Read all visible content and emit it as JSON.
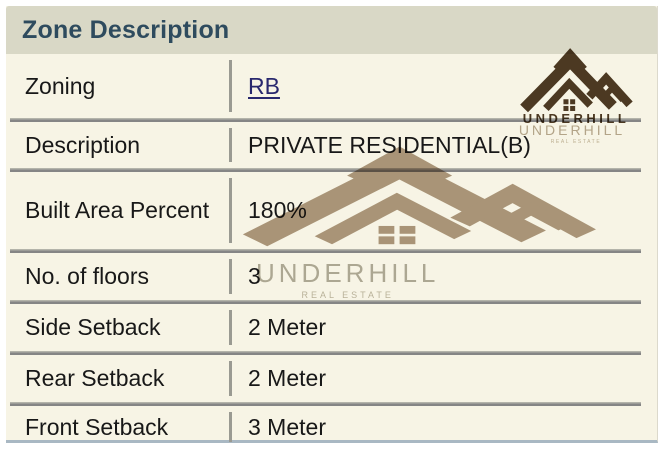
{
  "header": {
    "title": "Zone Description"
  },
  "table": {
    "rows": [
      {
        "label": "Zoning",
        "value": "RB"
      },
      {
        "label": "Description",
        "value": "PRIVATE RESIDENTIAL(B)"
      },
      {
        "label": "Built Area Percent",
        "value": "180%"
      },
      {
        "label": "No. of floors",
        "value": "3"
      },
      {
        "label": "Side Setback",
        "value": "2 Meter"
      },
      {
        "label": "Rear Setback",
        "value": "2 Meter"
      },
      {
        "label": "Front Setback",
        "value": "3 Meter"
      }
    ]
  },
  "branding": {
    "logo_icon": "underhill-roofs-icon",
    "brand": "UNDERHILL",
    "tagline": "REAL ESTATE"
  },
  "colors": {
    "header-bg": "#d9d8c6",
    "title": "#2e4b5e",
    "body-bg": "#f7f4e5",
    "text": "#181818",
    "link": "#29286e",
    "separator": "#858585",
    "separator-light": "#b4b4aa",
    "divider": "#9a9a92",
    "logo-dark": "#4e3b25",
    "watermark-taupe": "#a8937b",
    "watermark-gray": "#b2afa3",
    "watermark-faded": "#b9ac97",
    "bottom-line": "#a9b8c3",
    "page-bg": "#ffffff"
  }
}
